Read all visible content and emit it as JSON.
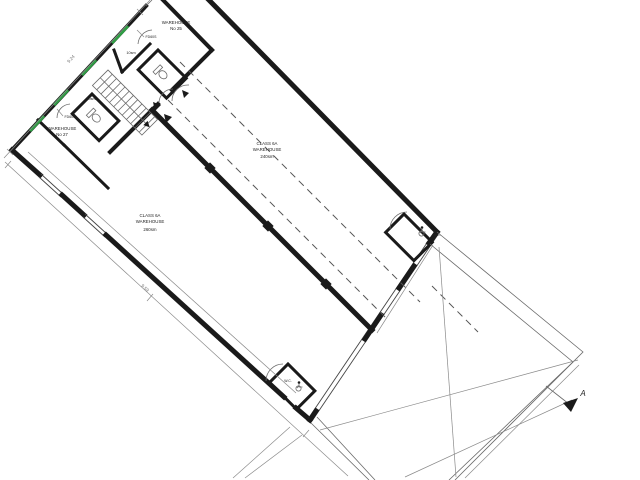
{
  "plan": {
    "title": "warehouse-floor-plan",
    "labels": {
      "w25_l1": "WAREHOUSE",
      "w25_l2": "No 25",
      "w27_l1": "WAREHOUSE",
      "w27_l2": "No 27",
      "c240_l1": "CLASS 6A",
      "c240_l2": "WAREHOUSE",
      "c240_l3": "240sm",
      "c260_l1": "CLASS 6A",
      "c260_l2": "WAREHOUSE",
      "c260_l3": "260sm",
      "area25": "10sm",
      "area27": "10sm",
      "fd1": "FD60S",
      "fd2": "FD60S",
      "wc1": "W.C.",
      "wc2": "W.C.",
      "dim_nw": "9.24",
      "dim_sw": "9.59",
      "section": "A"
    },
    "colors": {
      "wall": "#1a1a1a",
      "escape_route_green": "#2f9e44",
      "line": "#666666",
      "background": "#ffffff"
    }
  }
}
